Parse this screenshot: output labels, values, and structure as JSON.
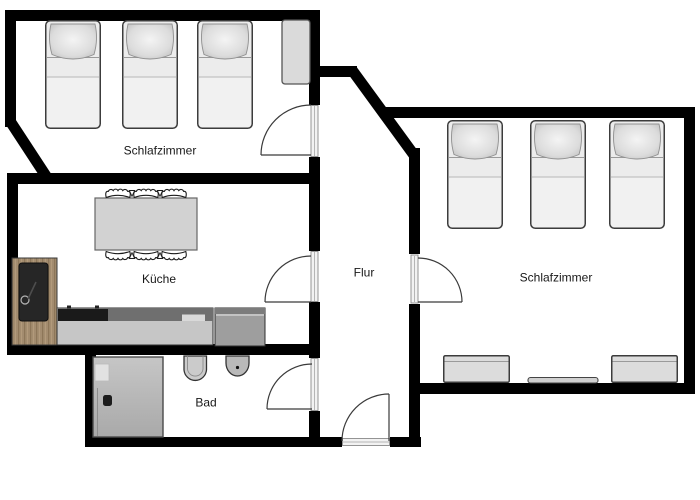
{
  "plan": {
    "type": "apartment-floor-plan",
    "rooms": [
      {
        "name": "bedroom-top-left",
        "label": "Schlafzimmer"
      },
      {
        "name": "kitchen",
        "label": "Küche"
      },
      {
        "name": "hallway",
        "label": "Flur"
      },
      {
        "name": "bathroom",
        "label": "Bad"
      },
      {
        "name": "bedroom-right",
        "label": "Schlafzimmer"
      }
    ],
    "furniture": {
      "bedroom_top_left": [
        "bed",
        "bed",
        "bed",
        "wardrobe"
      ],
      "bedroom_right": [
        "bed",
        "bed",
        "bed",
        "chest",
        "wall-shelf",
        "chest"
      ],
      "kitchen": [
        "dining-table",
        "chair-row-top",
        "chair-row-bottom",
        "tall-wood-cabinet",
        "countertop",
        "cooktop",
        "counter-unit"
      ],
      "bathroom": [
        "shower",
        "bidet",
        "toilet"
      ]
    },
    "doors": [
      {
        "name": "door-bedroom-left"
      },
      {
        "name": "door-kitchen"
      },
      {
        "name": "door-bathroom"
      },
      {
        "name": "door-bedroom-right"
      },
      {
        "name": "door-entrance"
      }
    ],
    "colors": {
      "wall": "#000000",
      "floor": "#ffffff",
      "furniture_fill": "#ececec",
      "furniture_stroke": "#3c3c3c",
      "pillow": "#d6d6d6",
      "wood": "#a38c6f",
      "counter_light": "#c6c6c6",
      "counter_dark": "#6f6f6f",
      "cooktop": "#1a1a1a",
      "shower": "#b9b9b9",
      "text": "#181818"
    }
  }
}
